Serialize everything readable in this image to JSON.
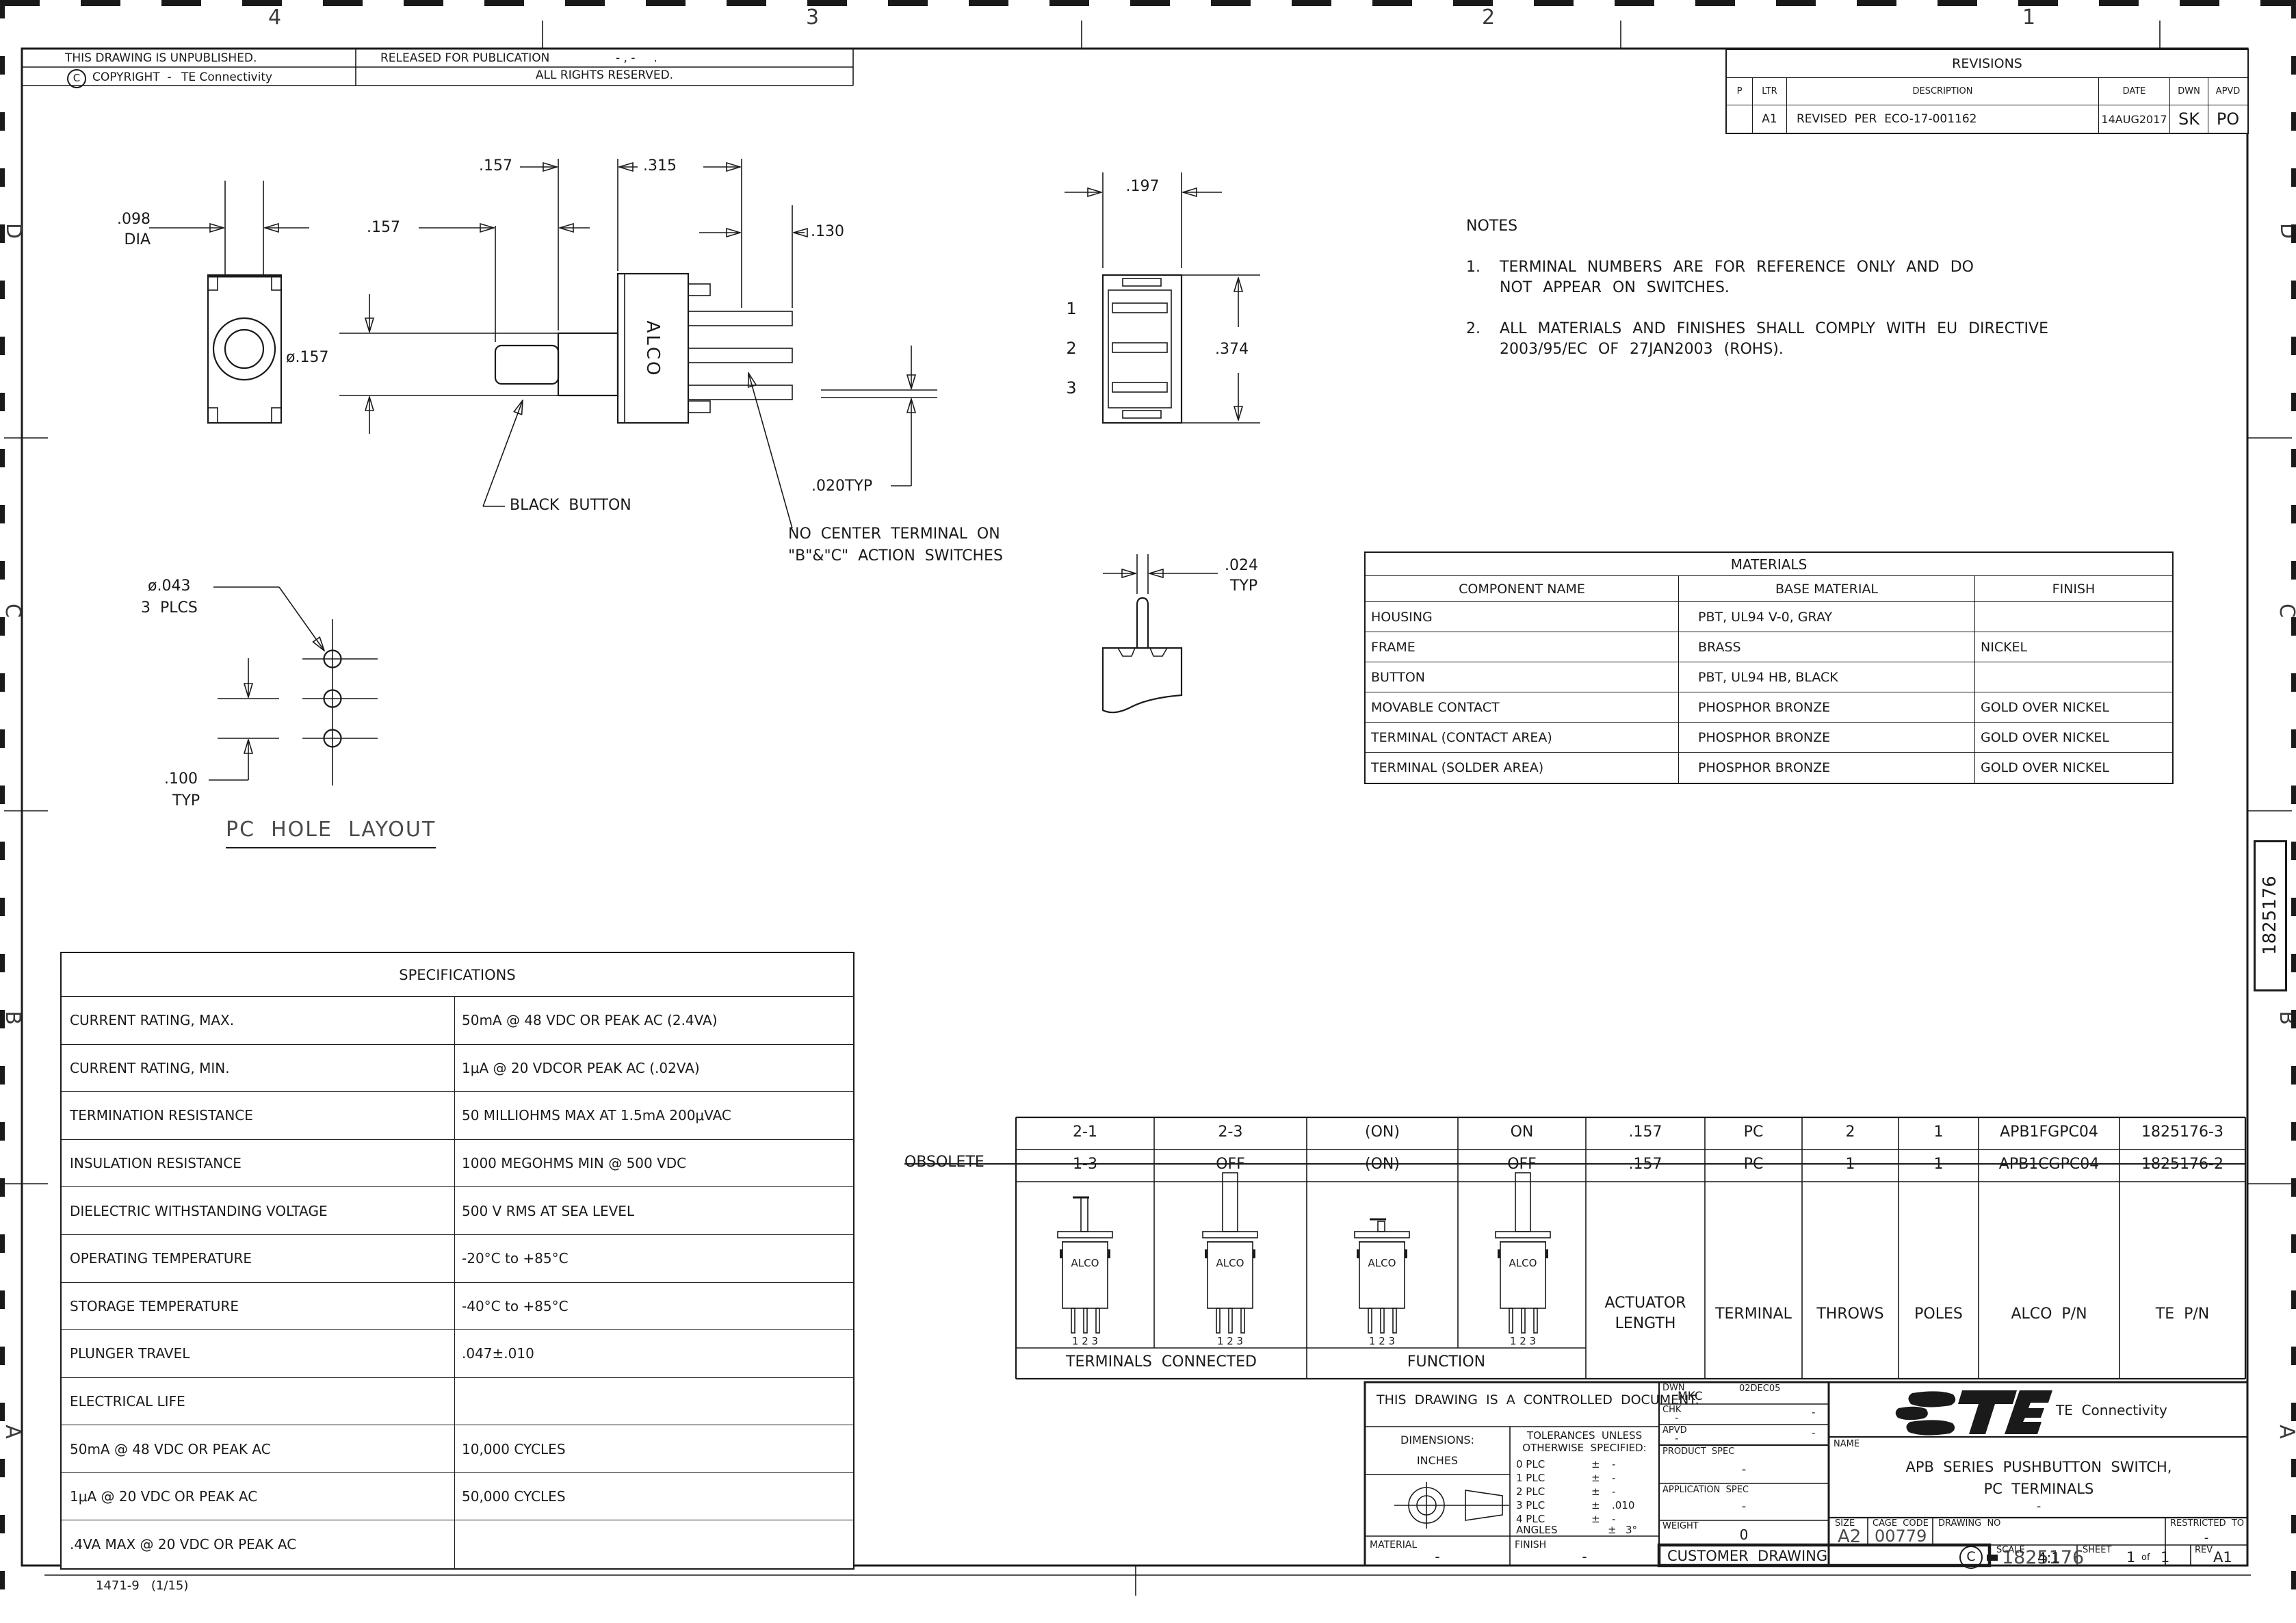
{
  "zones": {
    "top_numbers": [
      "4",
      "3",
      "2",
      "1"
    ],
    "left_letters": [
      "D",
      "C",
      "B",
      "A"
    ],
    "right_letters": [
      "D",
      "C",
      "B",
      "A"
    ],
    "tab_number": "1825176"
  },
  "header": {
    "unpublished": "THIS DRAWING IS UNPUBLISHED.",
    "released": "RELEASED FOR PUBLICATION",
    "released_date": "- , -     .",
    "rights": "ALL RIGHTS RESERVED.",
    "copyright_symbol": "C",
    "copyright_label": "COPYRIGHT  -",
    "company": "TE Connectivity"
  },
  "revisions": {
    "title": "REVISIONS",
    "col_p": "P",
    "col_ltr": "LTR",
    "col_desc": "DESCRIPTION",
    "col_date": "DATE",
    "col_dwn": "DWN",
    "col_apvd": "APVD",
    "row": {
      "p": "",
      "ltr": "A1",
      "desc": "REVISED  PER  ECO-17-001162",
      "date": "14AUG2017",
      "dwn": "SK",
      "apvd": "PO"
    }
  },
  "notes": {
    "title": "NOTES",
    "n1": "1.",
    "n1_line1": "TERMINAL NUMBERS ARE FOR REFERENCE ONLY AND DO",
    "n1_line2": "NOT APPEAR ON SWITCHES.",
    "n2": "2.",
    "n2_line1": "ALL MATERIALS AND FINISHES SHALL COMPLY WITH EU DIRECTIVE",
    "n2_line2": "2003/95/EC OF 27JAN2003 (ROHS)."
  },
  "materials": {
    "title": "MATERIALS",
    "headers": [
      "COMPONENT NAME",
      "BASE MATERIAL",
      "FINISH"
    ],
    "rows": [
      [
        "HOUSING",
        "PBT, UL94 V-0, GRAY",
        ""
      ],
      [
        "FRAME",
        "BRASS",
        "NICKEL"
      ],
      [
        "BUTTON",
        "PBT, UL94 HB, BLACK",
        ""
      ],
      [
        "MOVABLE CONTACT",
        "PHOSPHOR BRONZE",
        "GOLD OVER NICKEL"
      ],
      [
        "TERMINAL (CONTACT AREA)",
        "PHOSPHOR BRONZE",
        "GOLD OVER NICKEL"
      ],
      [
        "TERMINAL (SOLDER AREA)",
        "PHOSPHOR BRONZE",
        "GOLD OVER NICKEL"
      ]
    ]
  },
  "specifications": {
    "title": "SPECIFICATIONS",
    "rows": [
      [
        "CURRENT RATING, MAX.",
        "50mA @ 48 VDC OR PEAK AC (2.4VA)"
      ],
      [
        "CURRENT RATING, MIN.",
        "1μA @ 20 VDCOR PEAK AC (.02VA)"
      ],
      [
        "TERMINATION RESISTANCE",
        "50 MILLIOHMS MAX AT 1.5mA 200μVAC"
      ],
      [
        "INSULATION RESISTANCE",
        "1000 MEGOHMS MIN @ 500 VDC"
      ],
      [
        "DIELECTRIC WITHSTANDING VOLTAGE",
        "500 V RMS AT SEA LEVEL"
      ],
      [
        "OPERATING TEMPERATURE",
        "-20°C to +85°C"
      ],
      [
        "STORAGE TEMPERATURE",
        "-40°C to +85°C"
      ],
      [
        "PLUNGER TRAVEL",
        ".047±.010"
      ],
      [
        "ELECTRICAL LIFE",
        ""
      ],
      [
        "50mA @ 48 VDC OR PEAK AC",
        "10,000 CYCLES"
      ],
      [
        "1μA @ 20 VDC OR PEAK AC",
        "50,000 CYCLES"
      ],
      [
        ".4VA MAX @ 20 VDC OR PEAK AC",
        ""
      ]
    ]
  },
  "views": {
    "front": {
      "stem_dia_1": ".098",
      "stem_dia_2": "DIA"
    },
    "side": {
      "button_len": ".157",
      "flange_len": ".157",
      "body_len": ".315",
      "pin_len": ".130",
      "button_dia": "ø.157",
      "pin_thick": ".020TYP",
      "brand": "ALCO",
      "button_note": "BLACK  BUTTON",
      "terminal_note_1": "NO  CENTER  TERMINAL  ON",
      "terminal_note_2": "\"B\"&\"C\"  ACTION  SWITCHES"
    },
    "rear": {
      "width": ".197",
      "height": ".374",
      "t1": "1",
      "t2": "2",
      "t3": "3"
    },
    "terminal_detail": {
      "thickness": ".024",
      "typ": "TYP"
    },
    "pc_hole": {
      "hole_dia": "ø.043",
      "places": "3  PLCS",
      "pitch": ".100",
      "typ": "TYP",
      "title": "PC  HOLE  LAYOUT"
    }
  },
  "function_table": {
    "obsolete": "OBSOLETE",
    "rows": [
      {
        "ta": "2-1",
        "tb": "2-3",
        "fa": "(ON)",
        "fb": "ON",
        "act": ".157",
        "term": "PC",
        "throws": "2",
        "poles": "1",
        "alco": "APB1FGPC04",
        "te": "1825176-3"
      },
      {
        "ta": "1-3",
        "tb": "OFF",
        "fa": "(ON)",
        "fb": "OFF",
        "act": ".157",
        "term": "PC",
        "throws": "1",
        "poles": "1",
        "alco": "APB1CGPC04",
        "te": "1825176-2"
      }
    ],
    "headers": {
      "actuator_1": "ACTUATOR",
      "actuator_2": "LENGTH",
      "terminal": "TERMINAL",
      "throws": "THROWS",
      "poles": "POLES",
      "alco_pn": "ALCO  P/N",
      "te_pn": "TE  P/N",
      "terminals_connected": "TERMINALS  CONNECTED",
      "function": "FUNCTION"
    },
    "icon": {
      "brand": "ALCO",
      "pins": "1 2 3"
    }
  },
  "title_block": {
    "controlled": "THIS  DRAWING  IS  A  CONTROLLED  DOCUMENT.",
    "dimensions_label": "DIMENSIONS:",
    "dimensions_unit": "INCHES",
    "tolerances_1": "TOLERANCES  UNLESS",
    "tolerances_2": "OTHERWISE  SPECIFIED:",
    "tol_rows": [
      [
        "0 PLC",
        "±",
        "-"
      ],
      [
        "1 PLC",
        "±",
        "-"
      ],
      [
        "2 PLC",
        "±",
        "-"
      ],
      [
        "3 PLC",
        "±",
        ".010"
      ],
      [
        "4 PLC",
        "±",
        "-"
      ],
      [
        "ANGLES",
        "±",
        "3°"
      ]
    ],
    "material_label": "MATERIAL",
    "material_value": "-",
    "finish_label": "FINISH",
    "finish_value": "-",
    "dwn_label": "DWN",
    "dwn_value": "MKC",
    "dwn_date": "02DEC05",
    "chk_label": "CHK",
    "chk_value": "-",
    "chk_right": "-",
    "apvd_label": "APVD",
    "apvd_value": "-",
    "apvd_right": "-",
    "product_spec_label": "PRODUCT  SPEC",
    "product_spec_value": "-",
    "application_spec_label": "APPLICATION  SPEC",
    "application_spec_value": "-",
    "weight_label": "WEIGHT",
    "weight_value": "0",
    "customer_drawing": "CUSTOMER  DRAWING",
    "logo_text": "TE",
    "company": "TE  Connectivity",
    "name_label": "NAME",
    "name_1": "APB  SERIES  PUSHBUTTON  SWITCH,",
    "name_2": "PC  TERMINALS",
    "name_3": "-",
    "size_label": "SIZE",
    "size_value": "A2",
    "cage_label": "CAGE  CODE",
    "cage_value": "00779",
    "drawing_no_label": "DRAWING  NO",
    "drawing_no_prefix": "C",
    "drawing_no_value": "1825176",
    "restricted_label": "RESTRICTED  TO",
    "restricted_value": "-",
    "scale_label": "SCALE",
    "scale_value": "4:1",
    "sheet_label": "SHEET",
    "sheet_value": "1",
    "sheet_of": "of",
    "sheet_total": "1",
    "rev_label": "REV",
    "rev_value": "A1"
  },
  "footer": {
    "form": "1471-9   (1/15)"
  }
}
